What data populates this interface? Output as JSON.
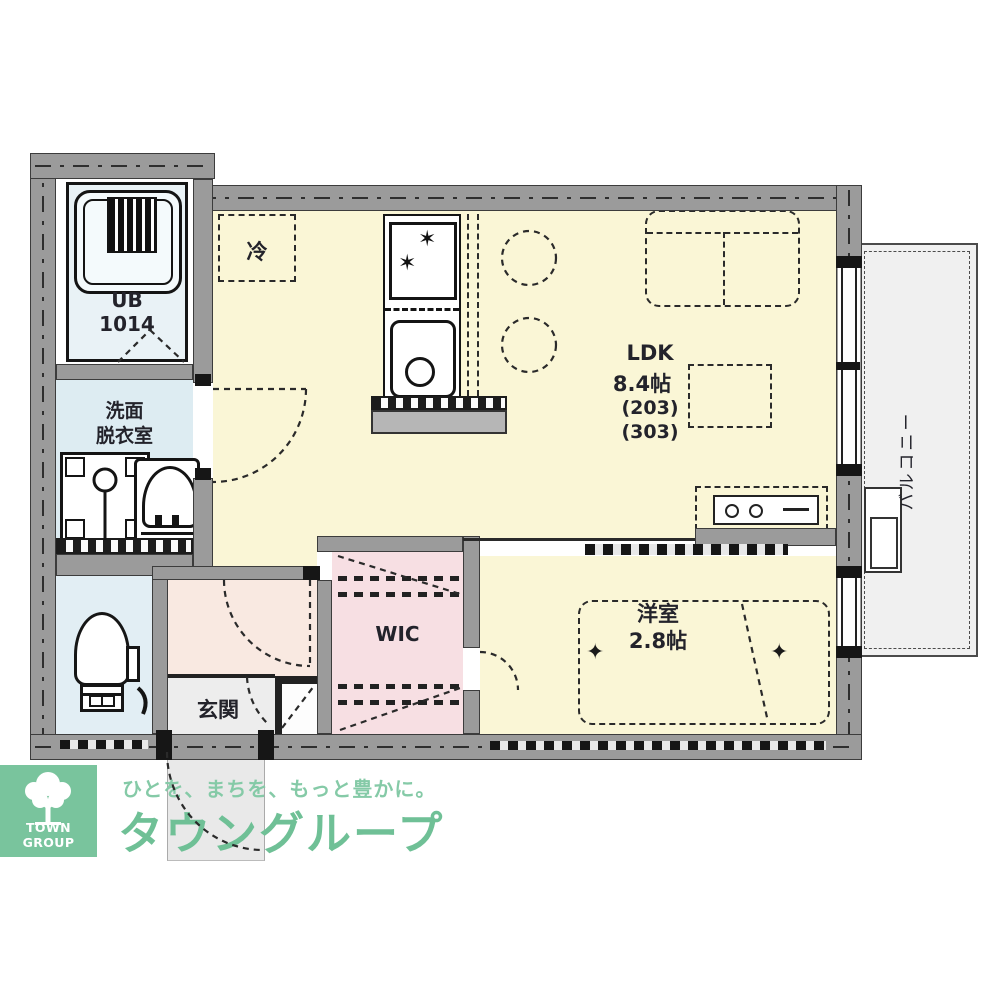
{
  "plan": {
    "rooms": {
      "ldk": {
        "label": "LDK",
        "size": "8.4帖",
        "unit_a": "(203)",
        "unit_b": "(303)"
      },
      "western_room": {
        "label": "洋室",
        "size": "2.8帖"
      },
      "wic": {
        "label": "WIC"
      },
      "entrance": {
        "label": "玄関"
      },
      "washroom": {
        "line1": "洗面",
        "line2": "脱衣室"
      },
      "unit_bath": {
        "label": "UB",
        "size": "1014"
      },
      "refrigerator": {
        "label": "冷"
      },
      "balcony": {
        "label": "バルコニー"
      }
    },
    "icons": {
      "bed_marker": "✦",
      "burner": "✶"
    }
  },
  "branding": {
    "logo_text": "TOWN GROUP",
    "tagline": "ひとを、まちを、もっと豊かに。",
    "company": "タウングループ",
    "colors": {
      "logo_bg": "#79c49d",
      "tagline_green": "#85caa7",
      "company_green": "#6fc096"
    }
  },
  "palette": {
    "floor_ldk": "#faf6d6",
    "floor_hall": "#f9e9e1",
    "floor_wic": "#f7dfe3",
    "floor_wet": "#ddecf2",
    "floor_entrance": "#ededed",
    "floor_balcony": "#f0f0f0",
    "wall_fill": "#9b9b9b"
  }
}
